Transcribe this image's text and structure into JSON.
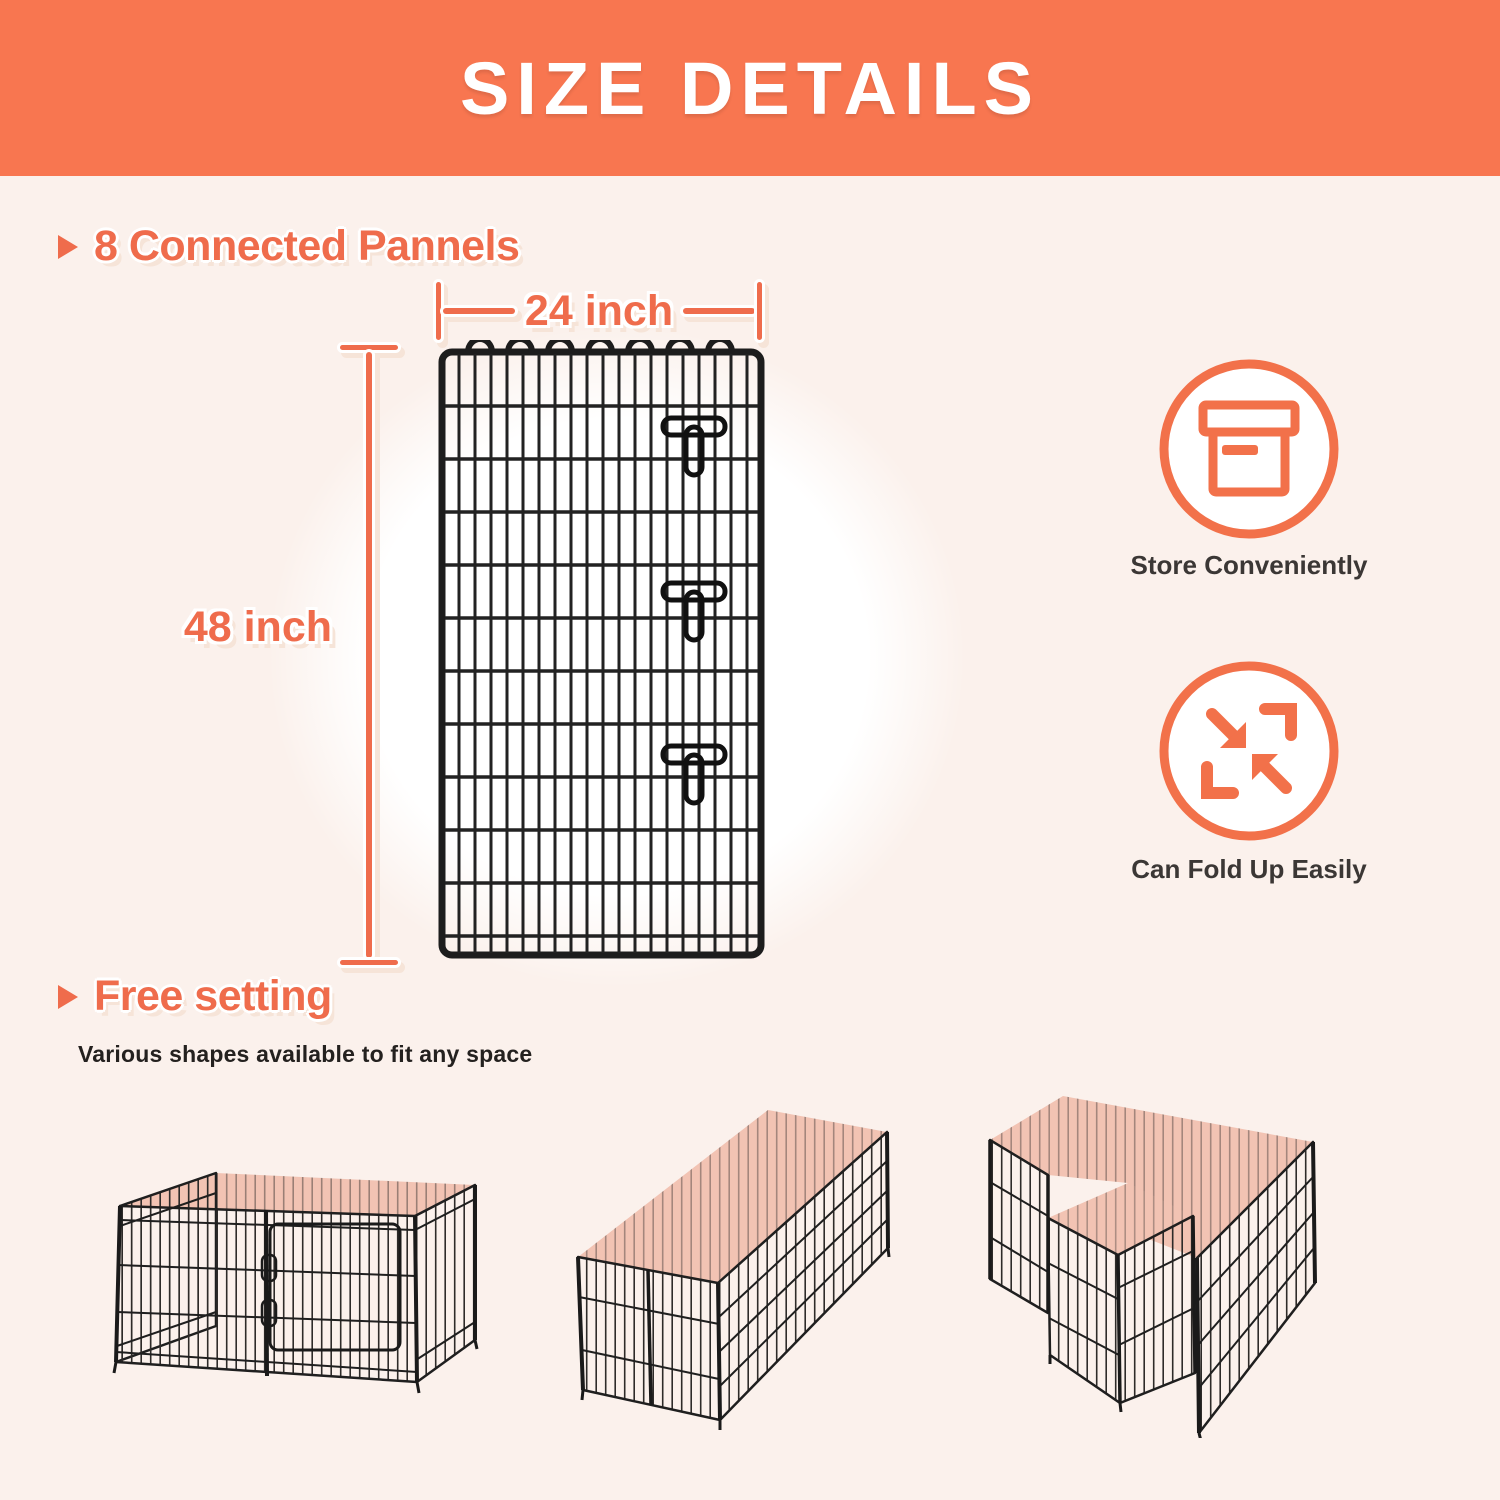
{
  "header": {
    "title": "SIZE DETAILS"
  },
  "panel_section": {
    "heading": "8 Connected Pannels",
    "width_label": "24 inch",
    "height_label": "48 inch"
  },
  "features": [
    {
      "icon": "storage-box-icon",
      "label": "Store Conveniently"
    },
    {
      "icon": "fold-arrows-icon",
      "label": "Can Fold Up Easily"
    }
  ],
  "free_setting_section": {
    "heading": "Free setting",
    "description": "Various shapes available to fit any space",
    "shape_illustrations": [
      "square-pen",
      "long-rectangle-pen",
      "t-shape-pen"
    ]
  },
  "colors": {
    "banner_bg": "#F87650",
    "accent_orange": "#EF6C4C",
    "page_bg": "#FBF1EC",
    "pen_interior_pink": "#F2C3B3",
    "wire_black": "#1E1E1E",
    "text_dark": "#3B3735",
    "backdrop_circle": "#FFFFFF"
  }
}
